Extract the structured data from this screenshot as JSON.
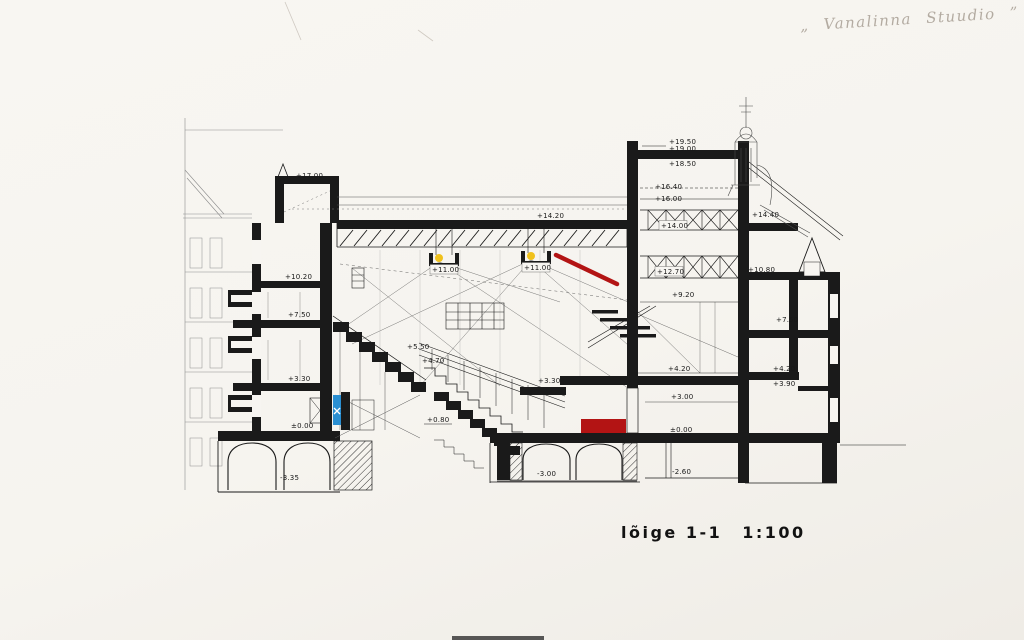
{
  "page": {
    "handwritten_note": "„ Vanalinna Stuudio ”",
    "caption_label": "lõige 1-1",
    "caption_scale": "1:100"
  },
  "drawing": {
    "type": "building-section",
    "accents": {
      "ink": "#1a1a1a",
      "red": "#b31414",
      "blue": "#2a8fd2",
      "yellow": "#f0c11c",
      "pencil": "#c9c3bb"
    },
    "labels": [
      {
        "text": "+17.00",
        "x": 296,
        "y": 178
      },
      {
        "text": "+10.20",
        "x": 285,
        "y": 279
      },
      {
        "text": "+7.50",
        "x": 288,
        "y": 317
      },
      {
        "text": "+3.30",
        "x": 288,
        "y": 381
      },
      {
        "text": "±0.00",
        "x": 291,
        "y": 428
      },
      {
        "text": "-3.35",
        "x": 280,
        "y": 480
      },
      {
        "text": "+14.20",
        "x": 537,
        "y": 218
      },
      {
        "text": "+11.00",
        "x": 432,
        "y": 272,
        "boxed": true
      },
      {
        "text": "+11.00",
        "x": 524,
        "y": 270,
        "boxed": true
      },
      {
        "text": "+5.50",
        "x": 407,
        "y": 349
      },
      {
        "text": "+4.70",
        "x": 422,
        "y": 363
      },
      {
        "text": "+3.30",
        "x": 538,
        "y": 383
      },
      {
        "text": "+0.80",
        "x": 427,
        "y": 422
      },
      {
        "text": "-3.00",
        "x": 537,
        "y": 476
      },
      {
        "text": "+19.50",
        "x": 669,
        "y": 144
      },
      {
        "text": "+19.00",
        "x": 669,
        "y": 151
      },
      {
        "text": "+18.50",
        "x": 669,
        "y": 166
      },
      {
        "text": "+16.40",
        "x": 655,
        "y": 189
      },
      {
        "text": "+16.00",
        "x": 655,
        "y": 201
      },
      {
        "text": "+14.00",
        "x": 661,
        "y": 228,
        "boxed": true
      },
      {
        "text": "+12.70",
        "x": 657,
        "y": 274,
        "boxed": true
      },
      {
        "text": "+9.20",
        "x": 672,
        "y": 297
      },
      {
        "text": "+4.20",
        "x": 668,
        "y": 371
      },
      {
        "text": "+3.00",
        "x": 671,
        "y": 399
      },
      {
        "text": "±0.00",
        "x": 670,
        "y": 432
      },
      {
        "text": "-2.60",
        "x": 672,
        "y": 474
      },
      {
        "text": "+14.40",
        "x": 752,
        "y": 217
      },
      {
        "text": "+10.80",
        "x": 748,
        "y": 272
      },
      {
        "text": "+7.50",
        "x": 776,
        "y": 322
      },
      {
        "text": "+4.20",
        "x": 773,
        "y": 371
      },
      {
        "text": "+3.90",
        "x": 773,
        "y": 386
      }
    ]
  }
}
